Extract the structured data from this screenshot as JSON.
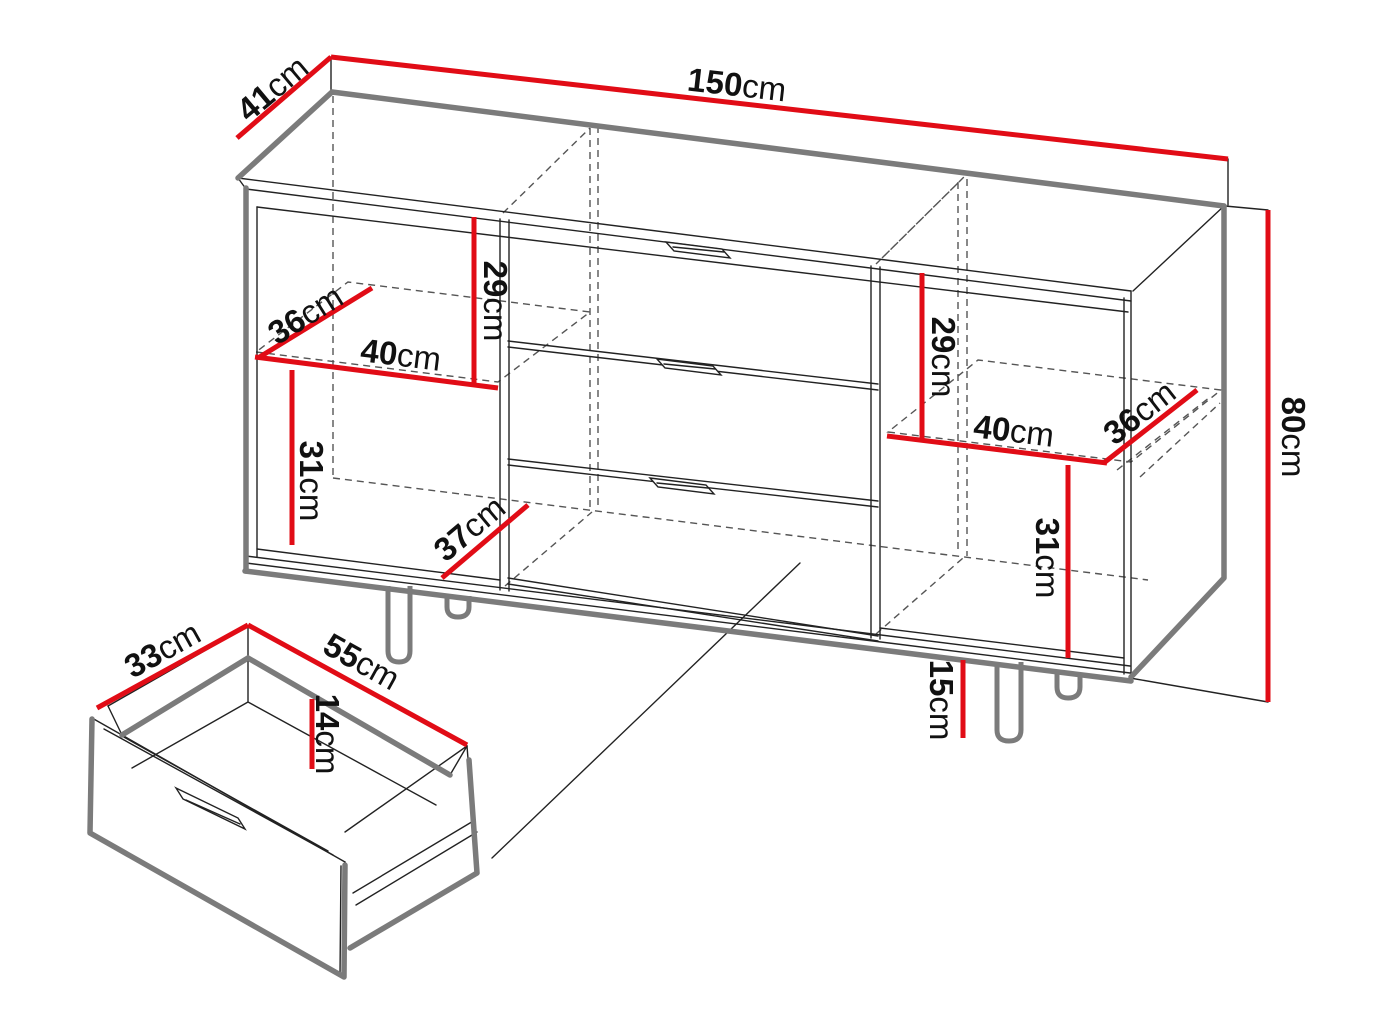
{
  "diagram": {
    "type": "furniture-technical-drawing",
    "subject": "sideboard with three central drawers, two shelved side compartments, legs, and a detached drawer detail",
    "unit": "cm",
    "colors": {
      "dimension_red": "#e10c16",
      "edge_gray": "#7b7b7b",
      "line_dark": "#222222",
      "dashed": "#555555",
      "text": "#111111",
      "background": "#ffffff"
    },
    "cabinet": {
      "width": {
        "num": "150",
        "unit": "cm"
      },
      "depth": {
        "num": "41",
        "unit": "cm"
      },
      "height": {
        "num": "80",
        "unit": "cm"
      },
      "leg_height": {
        "num": "15",
        "unit": "cm"
      },
      "left_compartment": {
        "above_shelf": {
          "num": "29",
          "unit": "cm"
        },
        "shelf_depth": {
          "num": "36",
          "unit": "cm"
        },
        "shelf_width": {
          "num": "40",
          "unit": "cm"
        },
        "below_shelf": {
          "num": "31",
          "unit": "cm"
        },
        "interior_depth": {
          "num": "37",
          "unit": "cm"
        }
      },
      "right_compartment": {
        "above_shelf": {
          "num": "29",
          "unit": "cm"
        },
        "shelf_width": {
          "num": "40",
          "unit": "cm"
        },
        "shelf_depth": {
          "num": "36",
          "unit": "cm"
        },
        "below_shelf": {
          "num": "31",
          "unit": "cm"
        }
      }
    },
    "drawer_detail": {
      "depth": {
        "num": "33",
        "unit": "cm"
      },
      "width": {
        "num": "55",
        "unit": "cm"
      },
      "inner_height": {
        "num": "14",
        "unit": "cm"
      }
    }
  }
}
